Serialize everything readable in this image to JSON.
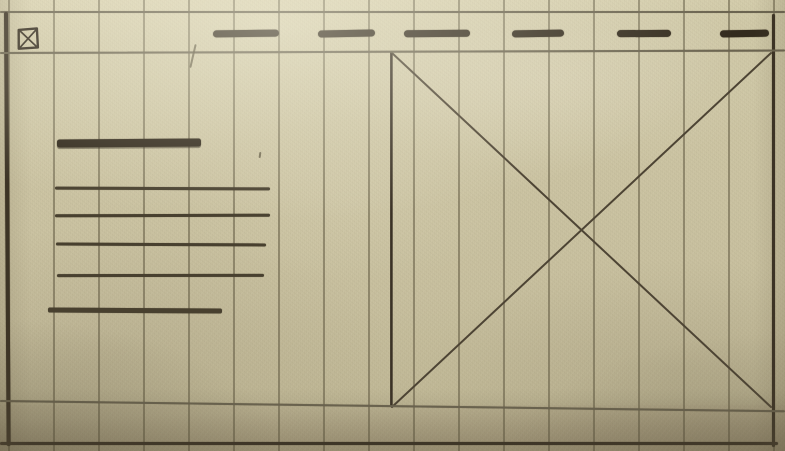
{
  "meta": {
    "title": "Hand-drawn website wireframe sketch",
    "medium": "pen and pencil on beige columnar paper",
    "canvas": {
      "width": 785,
      "height": 451
    }
  },
  "palette": {
    "paper": "#cbc3a1",
    "paper_light": "#d8d1b0",
    "paper_shadow": "#a99d7e",
    "column_rule": "rgba(92,84,62,0.52)",
    "ink": "#372e21",
    "pencil": "#6b6450"
  },
  "grid": {
    "start_x": 8,
    "spacing": 45,
    "count": 18
  },
  "borders": {
    "top_y": 10.5,
    "left_x": 4,
    "right_x": 772,
    "bottom_y": 442
  },
  "header": {
    "logo": {
      "x": 17,
      "y": 27,
      "w": 22,
      "h": 23,
      "tilt": -2,
      "icon": "box-with-x-icon"
    },
    "nav_y": 30,
    "separator_y": 52,
    "nav_items": [
      {
        "x": 213,
        "w": 66
      },
      {
        "x": 318,
        "w": 57
      },
      {
        "x": 404,
        "w": 66
      },
      {
        "x": 512,
        "w": 52
      },
      {
        "x": 617,
        "w": 54
      },
      {
        "x": 720,
        "w": 49
      }
    ]
  },
  "content": {
    "heading": {
      "x": 57,
      "y": 139,
      "w": 144,
      "h": 7.5,
      "tilt": -0.4
    },
    "lines": [
      {
        "x": 55,
        "y": 187,
        "w": 215,
        "h": 2.6,
        "tilt": 0.2
      },
      {
        "x": 55,
        "y": 214,
        "w": 215,
        "h": 2.6,
        "tilt": -0.15
      },
      {
        "x": 56,
        "y": 243,
        "w": 210,
        "h": 2.6,
        "tilt": 0.25
      },
      {
        "x": 57,
        "y": 274,
        "w": 207,
        "h": 2.6,
        "tilt": -0.1
      },
      {
        "x": 48,
        "y": 308,
        "w": 174,
        "h": 4.5,
        "tilt": 0.3
      }
    ]
  },
  "image_placeholder": {
    "x": 390,
    "y": 51,
    "w": 383,
    "h": 357,
    "icon": "diagonal-cross-icon"
  },
  "footer": {
    "top_y": 400,
    "top_tilt": 0.75,
    "bottom_y": 442
  },
  "artifacts": [
    {
      "type": "tick",
      "x": 192,
      "y": 44,
      "w": 2,
      "h": 24,
      "tilt": 13
    },
    {
      "type": "dot",
      "x": 259,
      "y": 152,
      "w": 2,
      "h": 6,
      "tilt": 8
    }
  ]
}
